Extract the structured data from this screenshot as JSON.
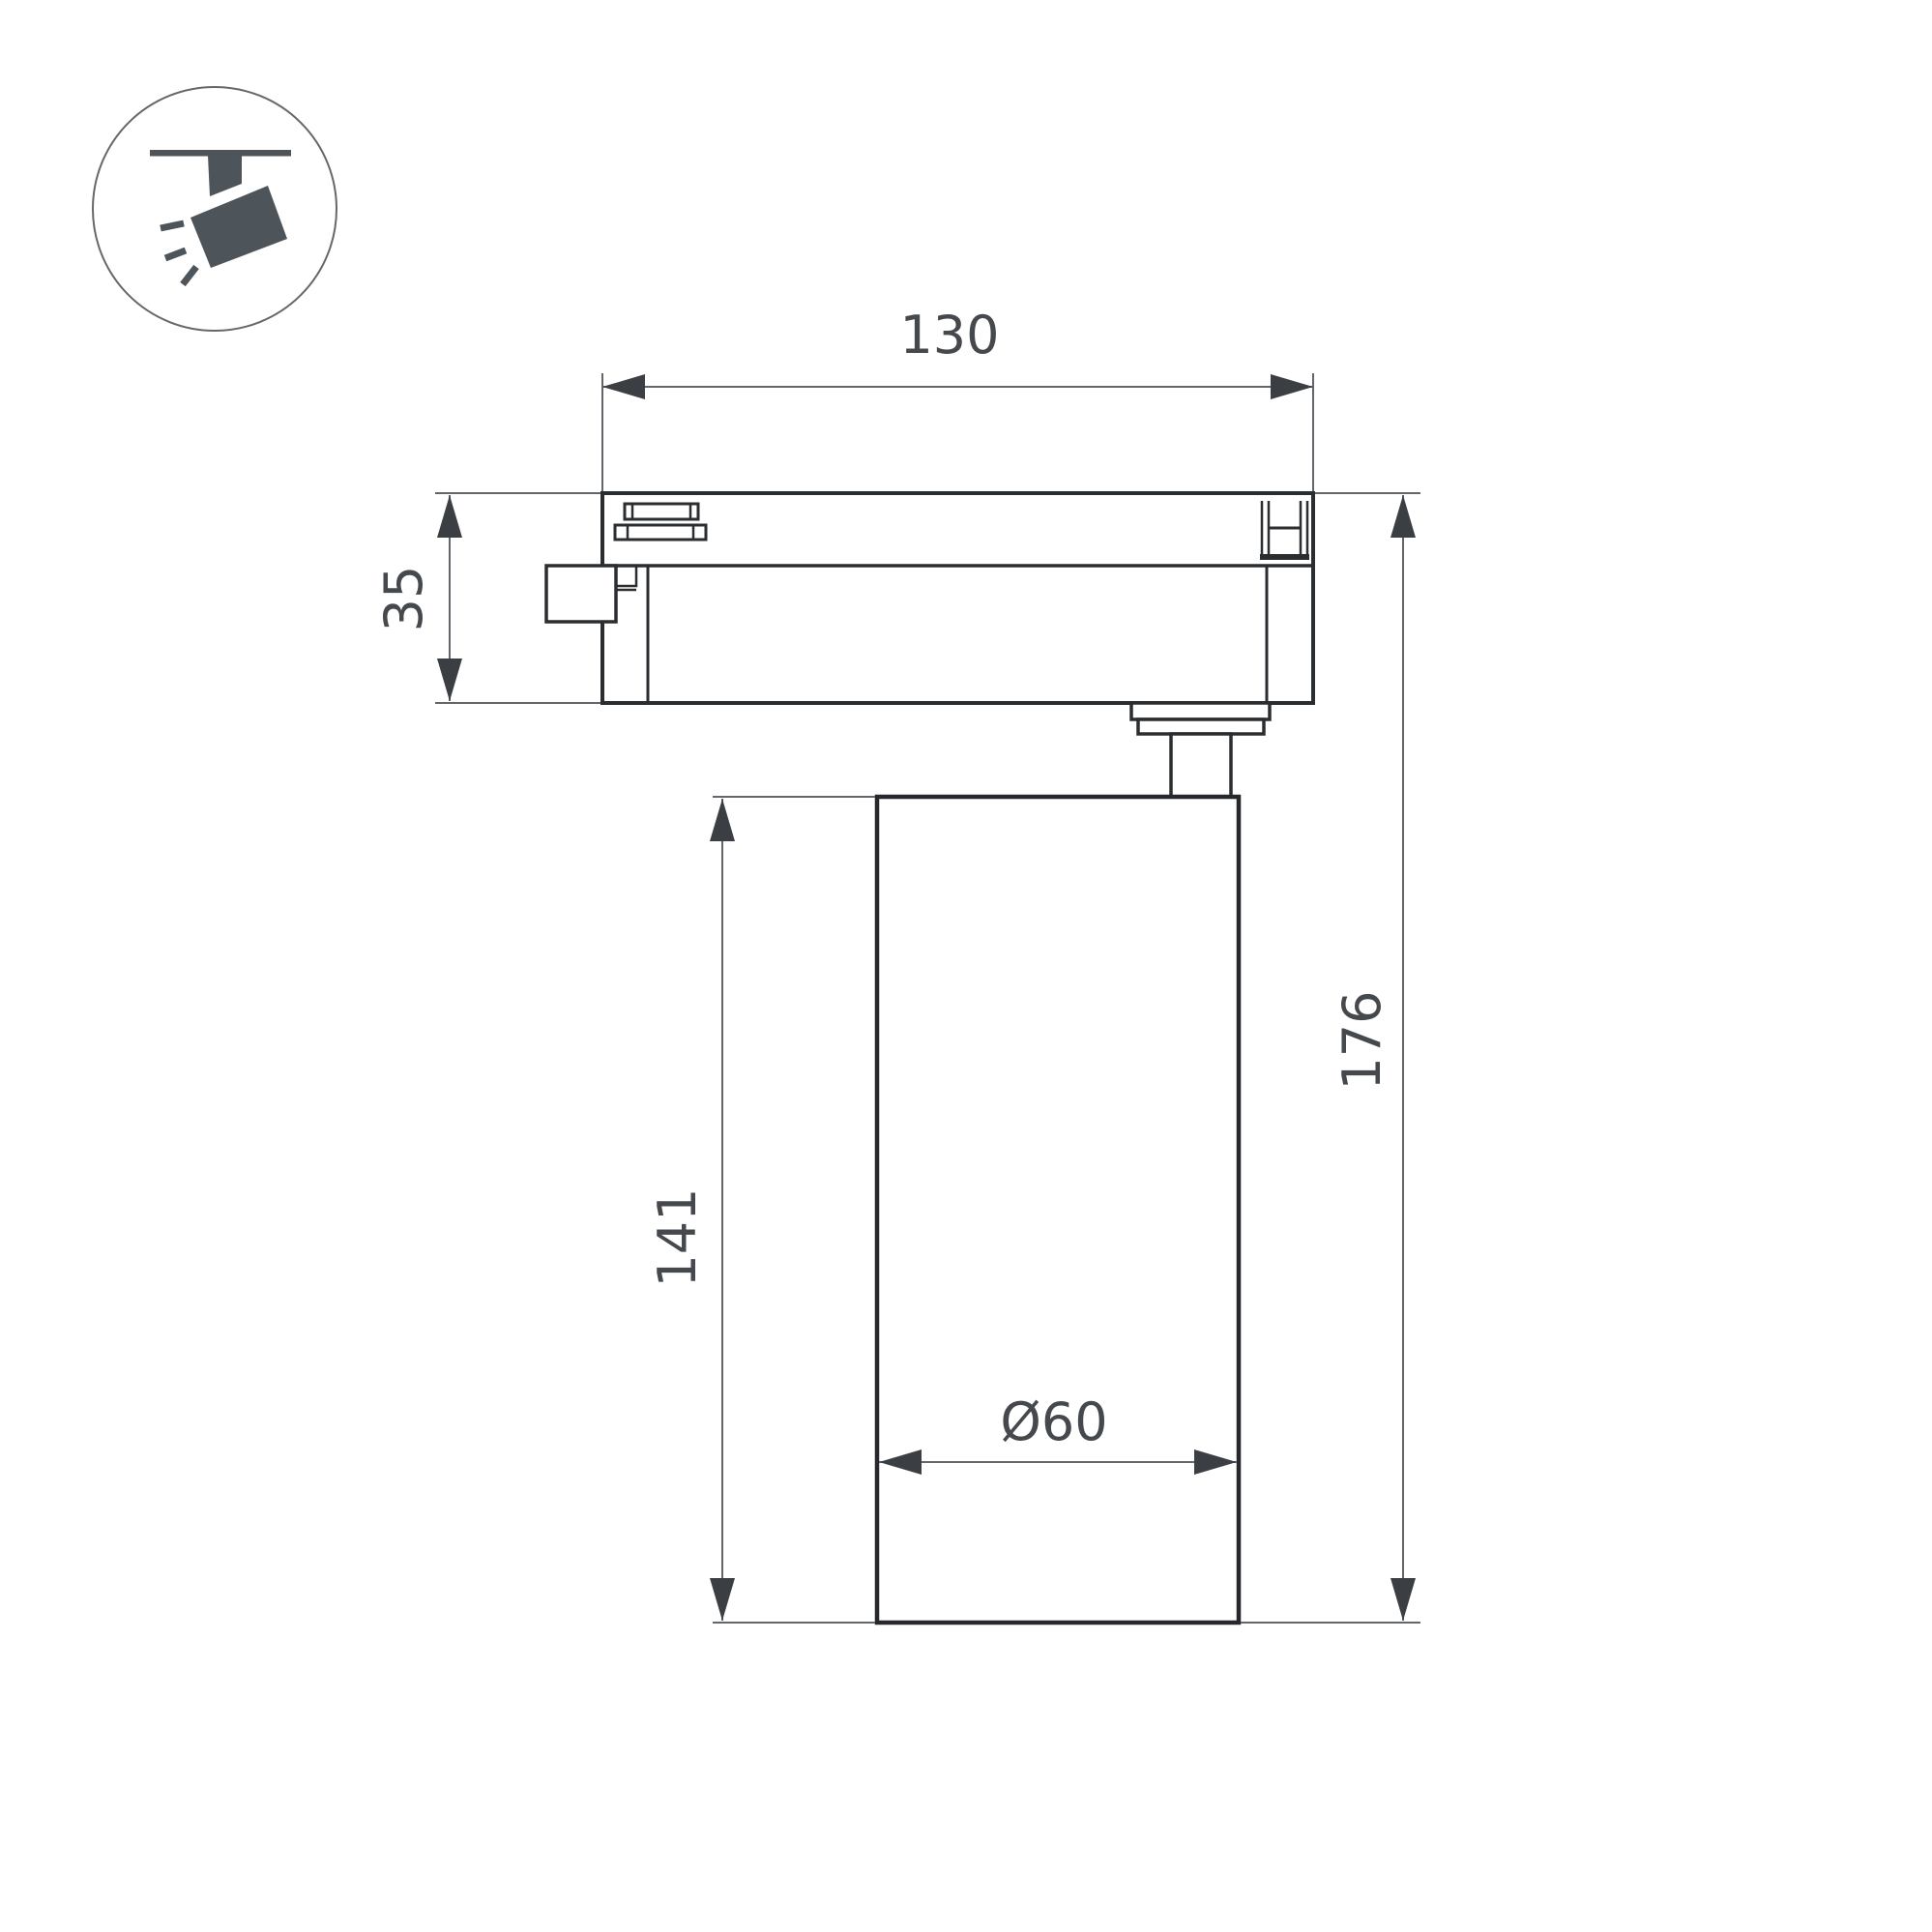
{
  "page": {
    "background": "#ffffff",
    "type": "technical-dimension-drawing",
    "subject": "track-mounted LED spotlight, side view",
    "units": "mm"
  },
  "icon": {
    "name": "track-spotlight-icon"
  },
  "dimensions": {
    "track_width": {
      "label": "130",
      "orientation": "horizontal",
      "measures": "track adapter width"
    },
    "adapter_height": {
      "label": "35",
      "orientation": "vertical",
      "measures": "track adapter height"
    },
    "body_height": {
      "label": "141",
      "orientation": "vertical",
      "measures": "lamp body height"
    },
    "total_height": {
      "label": "176",
      "orientation": "vertical",
      "measures": "overall height"
    },
    "diameter": {
      "label": "Ø60",
      "orientation": "horizontal",
      "measures": "lamp body diameter"
    }
  },
  "colors": {
    "outline": "#2b2e31",
    "dimension_line": "#63666a",
    "arrow": "#3b3f43",
    "text": "#45484c",
    "icon": "#4d545a"
  }
}
